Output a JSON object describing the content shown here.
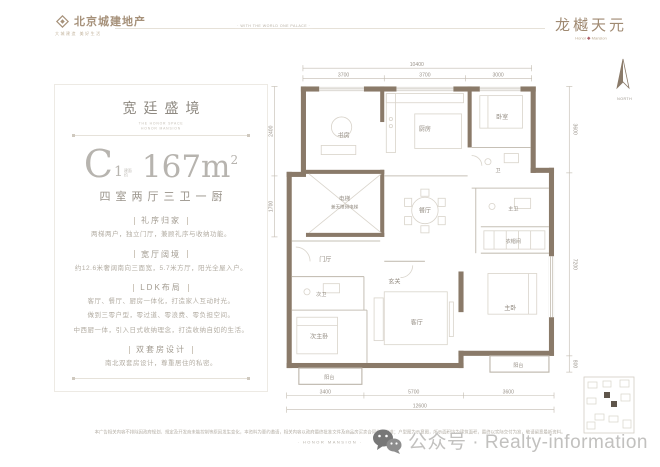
{
  "brand": {
    "left_logo_name": "北京城建地产",
    "left_logo_tagline": "大城建造 美好生活",
    "header_note": "· WITH THE WORLD ONE PALACE ·",
    "right_logo_name": "龙樾天元",
    "right_logo_sub_left": "Honor",
    "right_logo_sub_right": "Mansion"
  },
  "info_panel": {
    "title": "宽廷盛境",
    "subtitle_line1": "THE HONOR SPACE",
    "subtitle_line2": "HONOR MANSION",
    "unit_letter": "C",
    "unit_number": "1",
    "area_note": "建面约",
    "area_value": "167m",
    "area_sup": "2",
    "layout_text": "四室两厅三卫一厨",
    "sections": [
      {
        "heading": "礼序归家",
        "lines": [
          "两梯两户，独立门厅，兼顾礼序与收纳功能。"
        ]
      },
      {
        "heading": "宽厅阔境",
        "lines": [
          "约12.6米奢阔南向三面宽，5.7米方厅，阳光全屋入户。"
        ]
      },
      {
        "heading": "LDK布局",
        "lines": [
          "客厅、餐厅、厨房一体化，打造家人互动时光。",
          "做到三零户型，零过道、零浪费、零负担空间。",
          "中西厨一体，引入日式收纳理念，打造收纳自如的生活。"
        ]
      },
      {
        "heading": "双套房设计",
        "lines": [
          "南北双套房设计，尊重居住的私密。"
        ]
      }
    ]
  },
  "plan": {
    "north_label": "NORTH",
    "rooms": {
      "study": "书房",
      "kitchen": "厨房",
      "bedroom": "卧室",
      "bath": "卫",
      "elevator_1": "电梯",
      "elevator_2": "兼无障碍电梯",
      "hall": "门厅",
      "dining": "餐厅",
      "foyer": "玄关",
      "living": "客厅",
      "second_bath": "次卫",
      "second_master": "次主卧",
      "balcony_left": "阳台",
      "master_bath": "主卫",
      "closet": "衣帽间",
      "master": "主卧",
      "balcony_right": "阳台"
    },
    "dims": {
      "top_total": "10400",
      "top_1": "3700",
      "top_2": "3700",
      "top_3": "3000",
      "bottom_1": "3400",
      "bottom_2": "5700",
      "bottom_3": "3600",
      "bottom_total": "12600",
      "left_1": "2400",
      "left_2": "1700",
      "right_1": "3600",
      "right_2": "7200",
      "right_3": "800"
    }
  },
  "footer": {
    "disclaimer": "本广告相关内容不排除因政府规划、规定及开发商未能控制等原因发生变化，本资料为要约邀请，相关内容以政府最终批准文件及商品房买卖合同约定为准；户型图为示意图，所示面积均为建筑面积，最终以实际交付为准，敬请留意最新资料。",
    "motto": "· HONOR MANSION ·"
  },
  "watermark": {
    "label": "公众号 · Realty-information"
  }
}
